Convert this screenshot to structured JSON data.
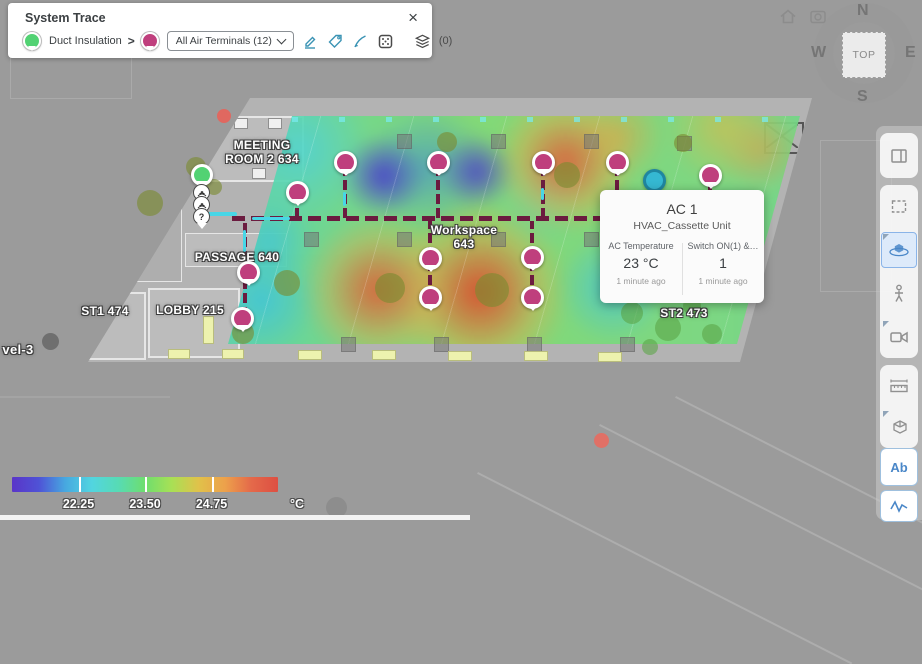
{
  "trace_panel": {
    "title": "System Trace",
    "close": "×",
    "source_label": "Duct Insulation",
    "separator": ">",
    "dropdown_label": "All Air Terminals (12)",
    "layers_count": "(0)",
    "tool_icons": [
      "draw-region-icon",
      "tag-icon",
      "pen-icon",
      "pixel-box-icon",
      "layers-icon"
    ]
  },
  "view_controls": {
    "icons": [
      "home-icon",
      "screenshot-icon"
    ]
  },
  "compass": {
    "n": "N",
    "e": "E",
    "s": "S",
    "w": "W",
    "top": "TOP"
  },
  "toolbar": {
    "text_tool_label": "Ab",
    "tools": [
      "split-view",
      "select-region",
      "orbit-3d",
      "first-person",
      "camera-view",
      "measure",
      "section-box",
      "text-annotation",
      "signal-graph"
    ],
    "active_tool": "orbit-3d"
  },
  "map": {
    "labels": [
      {
        "id": "meeting-room",
        "text": "MEETING\nROOM 2 634",
        "x": 262,
        "y": 139
      },
      {
        "id": "passage",
        "text": "PASSAGE 640",
        "x": 237,
        "y": 251
      },
      {
        "id": "workspace",
        "text": "Workspace\n643",
        "x": 464,
        "y": 224
      },
      {
        "id": "lobby",
        "text": "LOBBY 215",
        "x": 190,
        "y": 304
      },
      {
        "id": "st1",
        "text": "ST1 474",
        "x": 105,
        "y": 305
      },
      {
        "id": "st2",
        "text": "ST2 473",
        "x": 684,
        "y": 307
      },
      {
        "id": "level",
        "text": "vel-3",
        "x": 18,
        "y": 343
      }
    ],
    "pins": [
      {
        "x": 345,
        "y": 162
      },
      {
        "x": 438,
        "y": 162
      },
      {
        "x": 543,
        "y": 162
      },
      {
        "x": 617,
        "y": 162
      },
      {
        "x": 710,
        "y": 175
      },
      {
        "x": 297,
        "y": 192
      },
      {
        "x": 248,
        "y": 272
      },
      {
        "x": 242,
        "y": 318
      },
      {
        "x": 430,
        "y": 258
      },
      {
        "x": 430,
        "y": 297
      },
      {
        "x": 532,
        "y": 257
      },
      {
        "x": 532,
        "y": 297
      }
    ],
    "selected_unit": {
      "x": 653,
      "y": 179
    },
    "source_cluster": {
      "x": 200,
      "y": 172,
      "items": [
        "source-pin",
        "signal-marker",
        "signal-marker",
        "question-marker"
      ],
      "question": "?"
    }
  },
  "tooltip": {
    "title": "AC 1",
    "subtitle": "HVAC_Cassette Unit",
    "metrics": [
      {
        "label": "AC Temperature",
        "value": "23 °C",
        "time": "1 minute ago"
      },
      {
        "label": "Switch ON(1) &…",
        "value": "1",
        "time": "1 minute ago"
      }
    ]
  },
  "legend": {
    "ticks": [
      {
        "value": "22.25",
        "pct": 25
      },
      {
        "value": "23.50",
        "pct": 50
      },
      {
        "value": "24.75",
        "pct": 75
      }
    ],
    "unit": "°C",
    "gradient": [
      "#5a35c8",
      "#4f52d6",
      "#47a8e0",
      "#52d5e0",
      "#57dbb4",
      "#6ede6e",
      "#a8e055",
      "#e0c24a",
      "#eda14b",
      "#e4694a",
      "#dd4f42"
    ]
  },
  "colors": {
    "accent_teal": "#3a93b4",
    "terminal_pin": "#bf3f7d",
    "source_pin": "#52d273",
    "selected_unit": "#35b8d2",
    "duct": "#6b1b3f",
    "active_tool": "#4a87c8"
  }
}
